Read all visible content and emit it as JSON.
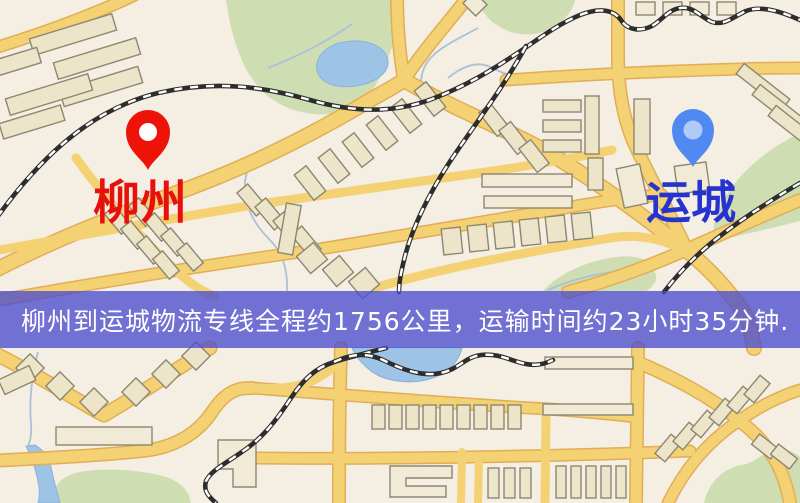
{
  "banner": {
    "text": "柳州到运城物流专线全程约1756公里，运输时间约23小时35分钟.",
    "background_color": "#4b4dce",
    "background_opacity": "0.78",
    "text_color": "#ffffff"
  },
  "markers": {
    "origin": {
      "label": "柳州",
      "icon": "red-map-pin-icon",
      "pin_color": "#ee1309",
      "pin_inner_color": "#ffffff",
      "label_color": "#e8100c"
    },
    "destination": {
      "label": "运城",
      "icon": "blue-map-pin-icon",
      "pin_color": "#5189f2",
      "pin_inner_color": "#ffffff",
      "label_color": "#2633cf"
    }
  },
  "route": {
    "origin": "柳州",
    "destination": "运城",
    "service": "物流专线",
    "distance_text": "全程约1756公里",
    "duration_text": "运输时间约23小时35分钟"
  },
  "map": {
    "colors": {
      "background": "#f4eee3",
      "road_fill": "#f4d173",
      "road_casing": "#e0ae55",
      "park": "#cfdeb2",
      "water": "#9dc3e7",
      "railway_dark": "#2d2d2d",
      "railway_dash": "#ffffff",
      "building_fill": "#ece5ca",
      "building_outline": "#8d8771"
    }
  }
}
